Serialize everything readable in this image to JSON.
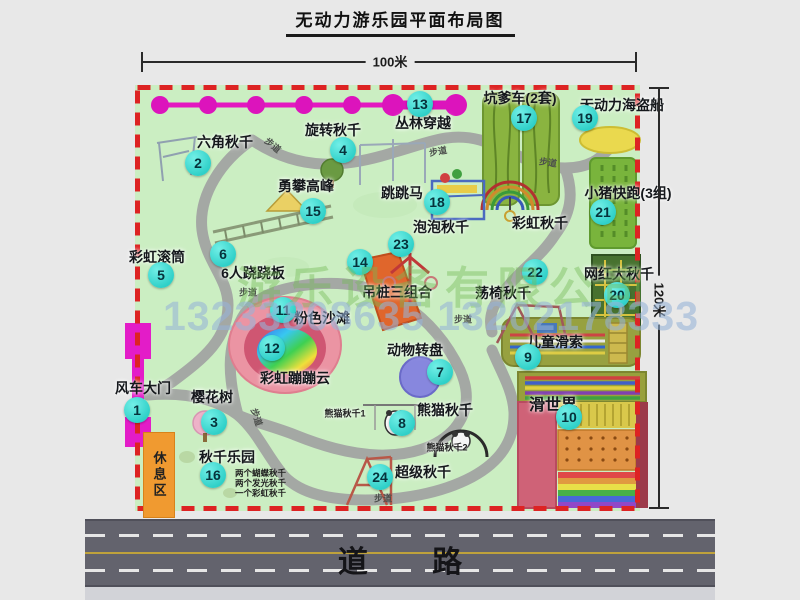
{
  "title": "无动力游乐园平面布局图",
  "dimensions": {
    "width_label": "100米",
    "height_label": "120米"
  },
  "road": {
    "label": "道 路"
  },
  "watermark": {
    "company": "游乐设备有限公司",
    "phone": "13233808635 13202178333"
  },
  "extras": {
    "path_label": "步道",
    "rainbow_swing": "彩虹秋千",
    "rest_area": "休息区"
  },
  "colors": {
    "map_green": "#cbeec2",
    "border_red": "#dd2323",
    "badge_teal": "#2fd0c8",
    "gate_magenta": "#e31cc8",
    "road_gray": "#63636d",
    "rest_orange": "#f09a30"
  },
  "attractions": [
    {
      "id": "1",
      "label": "风车大门"
    },
    {
      "id": "2",
      "label": "六角秋千"
    },
    {
      "id": "3",
      "label": "樱花树"
    },
    {
      "id": "4",
      "label": "旋转秋千"
    },
    {
      "id": "5",
      "label": "彩虹滚筒"
    },
    {
      "id": "6",
      "label": "6人跷跷板"
    },
    {
      "id": "7",
      "label": "动物转盘"
    },
    {
      "id": "8",
      "label": "熊猫秋千",
      "subs": [
        "熊猫秋千1",
        "熊猫秋千2"
      ]
    },
    {
      "id": "9",
      "label": "儿童滑索"
    },
    {
      "id": "10",
      "label": "滑世界"
    },
    {
      "id": "11",
      "label": "粉色沙滩"
    },
    {
      "id": "12",
      "label": "彩虹蹦蹦云"
    },
    {
      "id": "13",
      "label": "丛林穿越"
    },
    {
      "id": "14",
      "label": "吊桩三组合"
    },
    {
      "id": "15",
      "label": "勇攀高峰"
    },
    {
      "id": "16",
      "label": "秋千乐园",
      "subs": [
        "两个蝴蝶秋千",
        "两个发光秋千",
        "一个彩虹秋千"
      ]
    },
    {
      "id": "17",
      "label": "坑爹车(2套)"
    },
    {
      "id": "18",
      "label": "跳跳马"
    },
    {
      "id": "19",
      "label": "无动力海盗船"
    },
    {
      "id": "20",
      "label": "网红大秋千"
    },
    {
      "id": "21",
      "label": "小猪快跑(3组)"
    },
    {
      "id": "22",
      "label": "荡椅秋千"
    },
    {
      "id": "23",
      "label": "泡泡秋千"
    },
    {
      "id": "24",
      "label": "超级秋千"
    }
  ]
}
